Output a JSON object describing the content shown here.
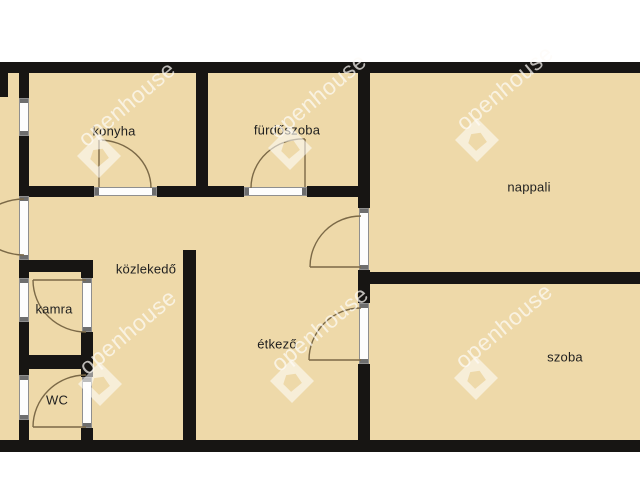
{
  "plan_type": "apartment-floorplan",
  "rooms": [
    {
      "name": "konyha",
      "label": "konyha"
    },
    {
      "name": "furdoszoba",
      "label": "fürdőszoba"
    },
    {
      "name": "nappali",
      "label": "nappali"
    },
    {
      "name": "kozlekedo",
      "label": "közlekedő"
    },
    {
      "name": "kamra",
      "label": "kamra"
    },
    {
      "name": "etkezo",
      "label": "étkező"
    },
    {
      "name": "wc",
      "label": "WC"
    },
    {
      "name": "szoba",
      "label": "szoba"
    }
  ],
  "watermark": {
    "text": "openhouse",
    "logo_icon": "openhouse-logo"
  },
  "colors": {
    "background": "#FFFFFF",
    "floor": "#EED9A9",
    "wall": "#171513",
    "opening_fill": "#FDFDFD",
    "opening_border": "#8F8F8F",
    "door_arc": "#7B6947",
    "label_text": "#1F1F1F",
    "watermark": "rgba(253,251,246,0.72)"
  }
}
